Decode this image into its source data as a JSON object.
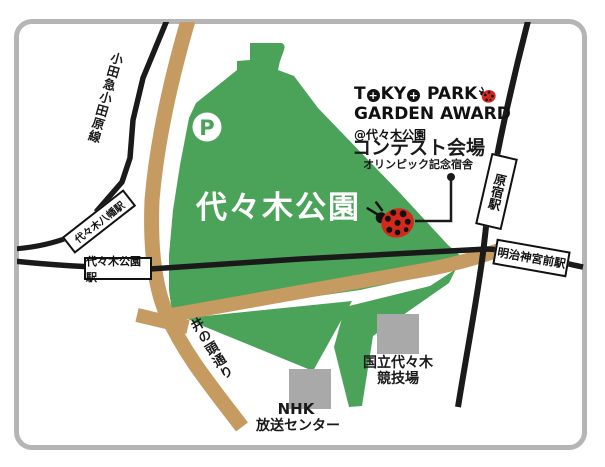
{
  "logo": {
    "line1": "TOKYO PARK",
    "line2": "GARDEN AWARD",
    "location": "@代々木公園"
  },
  "venue": {
    "label": "コンテスト会場",
    "sublabel": "オリンピック記念宿舎"
  },
  "park": {
    "name": "代々木公園",
    "parking": "P"
  },
  "stations": {
    "yoyogi_hachiman": "代々木八幡駅",
    "yoyogi_koen": "代々木公園駅",
    "harajuku": "原宿駅",
    "meiji_jingumae": "明治神宮前駅"
  },
  "roads": {
    "odakyu_odawara_line": "小田急小田原線",
    "inokashira_dori": "井の頭通り"
  },
  "buildings": {
    "nhk_line1": "NHK",
    "nhk_line2": "放送センター",
    "stadium_line1": "国立代々木",
    "stadium_line2": "競技場"
  },
  "colors": {
    "park_green": "#4ba35a",
    "road_tan": "#c69b62",
    "building_gray": "#a9a9a9",
    "frame_gray": "#b5b5b5",
    "line_black": "#1a1a1a",
    "ladybug_red": "#d3281c",
    "station_box_bg": "#ffffff"
  }
}
